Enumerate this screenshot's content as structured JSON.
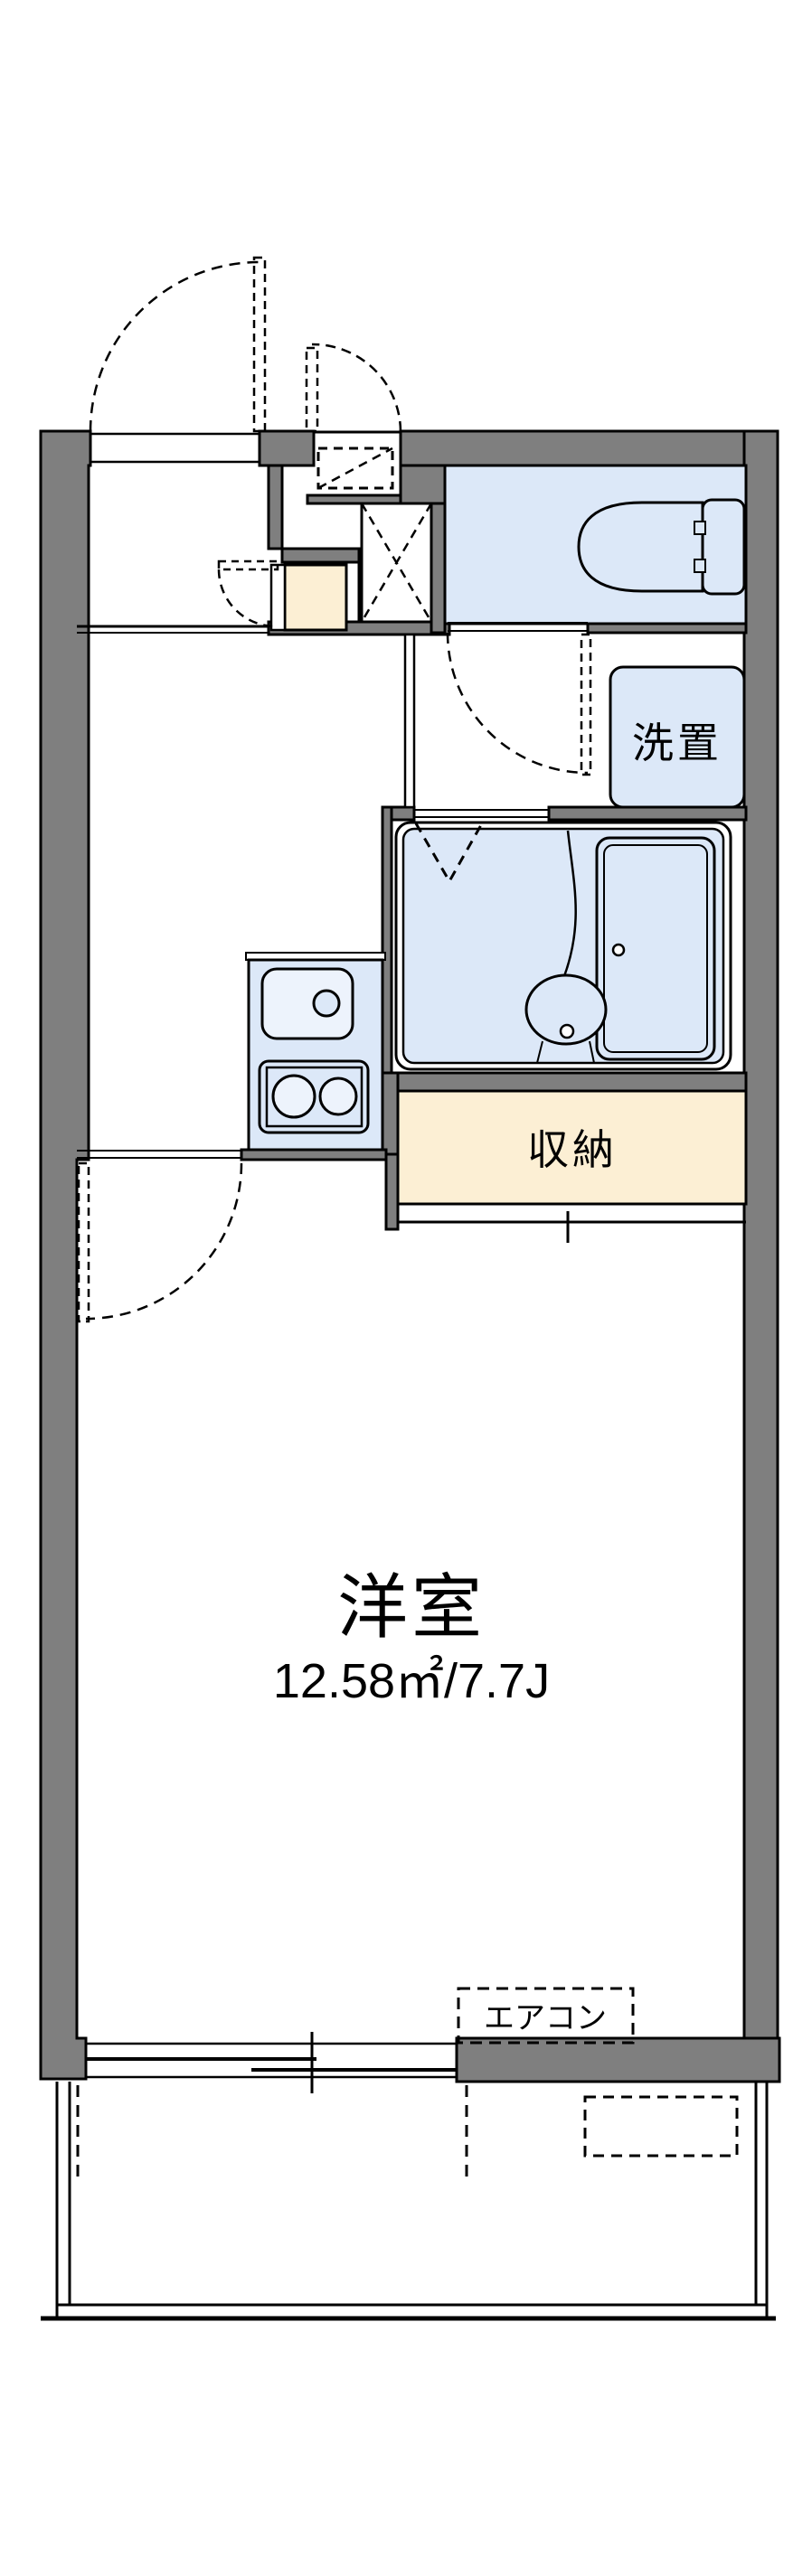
{
  "floor_plan": {
    "type": "apartment-1K-floorplan",
    "rooms": {
      "main_room": {
        "label": "洋室",
        "area_label": "12.58㎡/7.7J"
      },
      "closet": {
        "label": "収納"
      },
      "laundry_space": {
        "label": "洗置"
      },
      "aircon": {
        "label": "エアコン"
      }
    },
    "colors": {
      "wall_gray": "#7f7f7f",
      "water_blue": "#dce8f8",
      "water_blue_light": "#edf3fc",
      "storage_cream": "#fcefd4",
      "line_black": "#000000",
      "background": "#ffffff"
    }
  }
}
